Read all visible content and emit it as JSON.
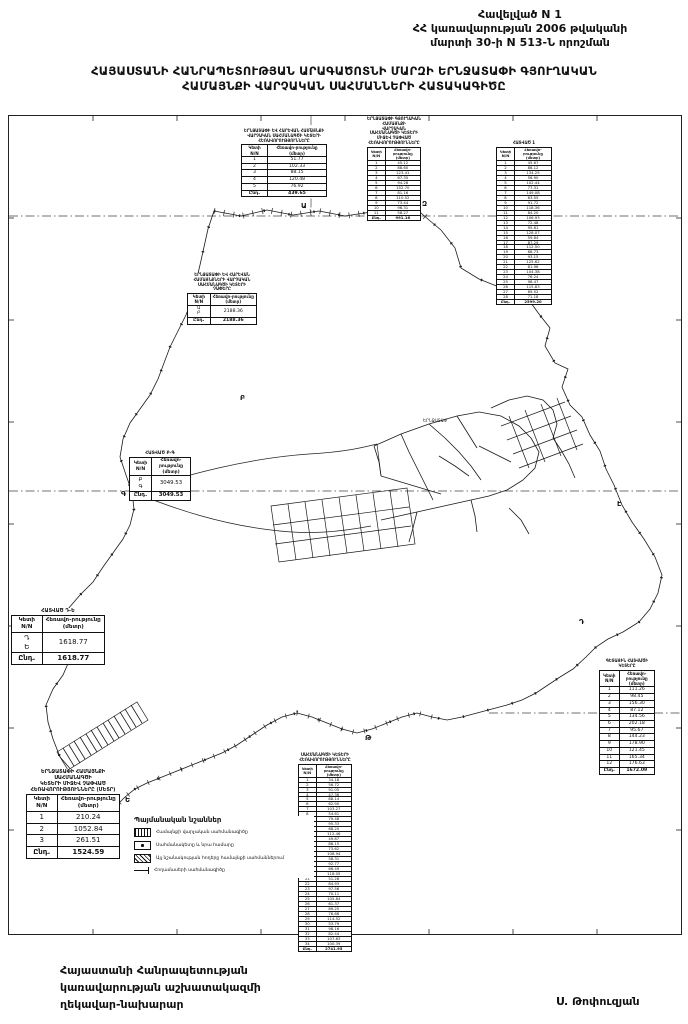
{
  "header": {
    "line1": "Հավելված N 1",
    "line2": "ՀՀ կառավարության 2006 թվականի",
    "line3": "մարտի 30-ի N 513-Ն որոշման"
  },
  "title": {
    "line1": "ՀԱՅԱՍՏԱՆԻ ՀԱՆՐԱՊԵՏՈՒԹՅԱՆ ԱՐԱԳԱԾՈՏՆԻ ՄԱՐԶԻ ԵՐՆՋԱՏԱՓԻ ԳՅՈՒՂԱԿԱՆ",
    "line2": "ՀԱՄԱՅՆՔԻ ՎԱՐՉԱԿԱՆ ՍԱՀՄԱՆՆԵՐԻ ՀԱՏԱԿԱԳԻԾԸ"
  },
  "map": {
    "settlement_label": "ԵՐՆՋԱՏԱՓ",
    "vertex_labels": [
      {
        "label": "Ա",
        "x": 292,
        "y": 92
      },
      {
        "label": "Զ",
        "x": 413,
        "y": 90
      },
      {
        "label": "Բ",
        "x": 231,
        "y": 284
      },
      {
        "label": "Գ",
        "x": 112,
        "y": 380
      },
      {
        "label": "Ը",
        "x": 84,
        "y": 520
      },
      {
        "label": "Ե",
        "x": 116,
        "y": 686
      },
      {
        "label": "Թ",
        "x": 356,
        "y": 624
      },
      {
        "label": "Դ",
        "x": 570,
        "y": 508
      },
      {
        "label": "Է",
        "x": 608,
        "y": 390
      }
    ]
  },
  "tables": [
    {
      "caption": [
        "ԵՐՆՋԱՏԱՓԻ ԵՎ ՀԱՐԵՎԱՆ ՀԱՄԱՅՆՔԻ",
        "ՎԱՐՉԱԿԱՆ ՍԱՀՄԱՆԱԳԾԻ ԿԵՏԵՐԻ",
        "ՀԵՌԱՎՈՐՈՒԹՅՈՒՆՆԵՐԸ"
      ],
      "col1": "Կետի N/N",
      "col2": "Հեռավո-րությունը (մետր)",
      "rows": [
        [
          "1",
          "51.77"
        ],
        [
          "2",
          "102.33"
        ],
        [
          "3",
          "88.15"
        ],
        [
          "4",
          "120.48"
        ],
        [
          "5",
          "76.92"
        ]
      ],
      "total": [
        "Ընդ.",
        "439.65"
      ],
      "size": "std"
    },
    {
      "caption": [
        "ԵՐՆՋԱՏԱՓԻ ԳՅՈՒՂԱԿԱՆ ՀԱՄԱՅՆՔԻ",
        "ՎԱՐՉԱԿԱՆ ՍԱՀՄԱՆԱԳԾԻ ԿԵՏԵՐԻ",
        "ՄԻՋԵՎ ՉԱՓՎԱԾ",
        "ՀԵՌԱՎՈՐՈՒԹՅՈՒՆՆԵՐԸ"
      ],
      "col1": "Կետի N/N",
      "col2": "Հեռավո-րությունը (մետր)",
      "rows": [
        [
          "1",
          "45.12"
        ],
        [
          "2",
          "88.60"
        ],
        [
          "3",
          "123.41"
        ],
        [
          "4",
          "67.35"
        ],
        [
          "5",
          "94.28"
        ],
        [
          "6",
          "152.70"
        ],
        [
          "7",
          "81.16"
        ],
        [
          "8",
          "110.52"
        ],
        [
          "9",
          "73.44"
        ],
        [
          "10",
          "96.31"
        ],
        [
          "11",
          "58.27"
        ]
      ],
      "total": [
        "Ընդ.",
        "991.16"
      ],
      "size": "small"
    },
    {
      "caption": [
        "ՀԱՏՎԱԾ 1"
      ],
      "col1": "Կետի N/N",
      "col2": "Հեռավո-րությունը (մետր)",
      "rows": [
        [
          "1",
          "45.67"
        ],
        [
          "2",
          "88.12"
        ],
        [
          "3",
          "134.25"
        ],
        [
          "4",
          "56.90"
        ],
        [
          "5",
          "102.44"
        ],
        [
          "6",
          "77.31"
        ],
        [
          "7",
          "149.08"
        ],
        [
          "8",
          "63.55"
        ],
        [
          "9",
          "91.72"
        ],
        [
          "10",
          "118.36"
        ],
        [
          "11",
          "84.20"
        ],
        [
          "12",
          "106.93"
        ],
        [
          "13",
          "72.48"
        ],
        [
          "14",
          "95.61"
        ],
        [
          "15",
          "128.07"
        ],
        [
          "16",
          "59.84"
        ],
        [
          "17",
          "87.29"
        ],
        [
          "18",
          "112.50"
        ],
        [
          "19",
          "68.73"
        ],
        [
          "20",
          "93.15"
        ],
        [
          "21",
          "125.62"
        ],
        [
          "22",
          "81.96"
        ],
        [
          "23",
          "104.38"
        ],
        [
          "24",
          "76.24"
        ],
        [
          "25",
          "98.47"
        ],
        [
          "26",
          "115.83"
        ],
        [
          "27",
          "89.52"
        ],
        [
          "28",
          "71.18"
        ]
      ],
      "total": [
        "Ընդ.",
        "2599.20"
      ],
      "size": "small"
    },
    {
      "caption": [
        "ԵՐՆՋԱՏԱՓԻ ԵՎ ՀԱՐԵՎԱՆ",
        "ՀԱՄԱՅՆՔՆԵՐԻ ՎԱՐՉԱԿԱՆ",
        "ՍԱՀՄԱՆԱԳԾԻ ԿԵՏԵՐԻ",
        "ՉԱՓԵՐԸ"
      ],
      "col1": "Կետի N/N",
      "col2": "Հեռավո-րությունը (մետր)",
      "rows": [
        [
          "Ա\nԲ",
          "2188.36"
        ]
      ],
      "total": [
        "Ընդ.",
        "2188.36"
      ],
      "size": "std"
    },
    {
      "caption": [
        "ՀԱՏՎԱԾ Բ-Գ"
      ],
      "col1": "Կետի N/N",
      "col2": "Հեռավո-րությունը (մետր)",
      "rows": [
        [
          "Բ\nԳ",
          "3049.53"
        ]
      ],
      "total": [
        "Ընդ.",
        "3049.53"
      ],
      "size": "med"
    },
    {
      "caption": [
        "ՀԱՏՎԱԾ Դ-Ե"
      ],
      "col1": "Կետի N/N",
      "col2": "Հեռավո-րությունը (մետր)",
      "rows": [
        [
          "Դ\nԵ",
          "1618.77"
        ]
      ],
      "total": [
        "Ընդ.",
        "1618.77"
      ],
      "size": "big"
    },
    {
      "caption": [
        "ԵՐՆՋԱՏԱՓԻ ՀԱՄԱՅՆՔԻ ՍԱՀՄԱՆԱԳԾԻ",
        "ԿԵՏԵՐԻ ՄԻՋԵՎ ՉԱՓՎԱԾ",
        "ՀԵՌԱՎՈՐՈՒԹՅՈՒՆՆԵՐԸ (ՄԵՏՐ)"
      ],
      "col1": "Կետի N/N",
      "col2": "Հեռավո-րությունը (մետր)",
      "rows": [
        [
          "1",
          "210.24"
        ],
        [
          "2",
          "1052.84"
        ],
        [
          "3",
          "261.51"
        ]
      ],
      "total": [
        "Ընդ.",
        "1524.59"
      ],
      "size": "big"
    },
    {
      "caption": [
        "ՍԱՀՄԱՆԱԳԾԻ ԿԵՏԵՐԻ",
        "ՀԵՌԱՎՈՐՈՒԹՅՈՒՆՆԵՐԸ"
      ],
      "col1": "Կետի N/N",
      "col2": "Հեռավո-րությունը (մետր)",
      "rows": [
        [
          "1",
          "34.18"
        ],
        [
          "2",
          "56.72"
        ],
        [
          "3",
          "91.05"
        ],
        [
          "4",
          "47.36"
        ],
        [
          "5",
          "88.14"
        ],
        [
          "6",
          "62.90"
        ],
        [
          "7",
          "103.27"
        ],
        [
          "8",
          "54.61"
        ],
        [
          "9",
          "79.48"
        ],
        [
          "10",
          "95.33"
        ],
        [
          "11",
          "68.20"
        ],
        [
          "12",
          "112.46"
        ],
        [
          "13",
          "49.87"
        ],
        [
          "14",
          "86.15"
        ],
        [
          "15",
          "73.62"
        ],
        [
          "16",
          "108.94"
        ],
        [
          "17",
          "58.31"
        ],
        [
          "18",
          "92.77"
        ],
        [
          "19",
          "66.49"
        ],
        [
          "20",
          "118.05"
        ],
        [
          "21",
          "51.28"
        ],
        [
          "22",
          "84.93"
        ],
        [
          "23",
          "97.56"
        ],
        [
          "24",
          "70.11"
        ],
        [
          "25",
          "105.84"
        ],
        [
          "26",
          "61.37"
        ],
        [
          "27",
          "89.25"
        ],
        [
          "28",
          "76.68"
        ],
        [
          "29",
          "114.52"
        ],
        [
          "30",
          "53.79"
        ],
        [
          "31",
          "98.16"
        ],
        [
          "32",
          "82.44"
        ],
        [
          "33",
          "107.63"
        ],
        [
          "34",
          "100.39"
        ]
      ],
      "total": [
        "Ընդ.",
        "2741.95"
      ],
      "size": "small"
    },
    {
      "caption": [
        "ԳԵՏԱՅԻՆ ՀԱՏՎԱԾԻ",
        "ԿԵՏԵՐԸ"
      ],
      "col1": "Կետի N/N",
      "col2": "Հեռավո-րությունը (մետր)",
      "rows": [
        [
          "1",
          "111.26"
        ],
        [
          "2",
          "98.45"
        ],
        [
          "3",
          "156.30"
        ],
        [
          "4",
          "87.12"
        ],
        [
          "5",
          "134.56"
        ],
        [
          "6",
          "202.18"
        ],
        [
          "7",
          "95.67"
        ],
        [
          "8",
          "144.23"
        ],
        [
          "9",
          "178.90"
        ],
        [
          "10",
          "121.45"
        ],
        [
          "11",
          "165.34"
        ],
        [
          "12",
          "176.63"
        ]
      ],
      "total": [
        "Ընդ.",
        "1672.09"
      ],
      "size": "std"
    }
  ],
  "legend": {
    "title": "Պայմանական նշաններ",
    "items": [
      {
        "symbol": "boundary",
        "label": "Համայնքի վարչական սահմանագիծը"
      },
      {
        "symbol": "marker",
        "label": "Սահմանակետը և նրա համարը"
      },
      {
        "symbol": "parcel",
        "label": "Այլ նշանակության հողերը համայնքի սահմաններում"
      },
      {
        "symbol": "line",
        "label": "Հողամասերի սահմանագիծը"
      }
    ]
  },
  "signature": {
    "line1": "Հայաստանի Հանրապետության",
    "line2": "կառավարության աշխատակազմի",
    "line3": "ղեկավար-նախարար",
    "signer": "Ս. Թոփուզյան"
  }
}
